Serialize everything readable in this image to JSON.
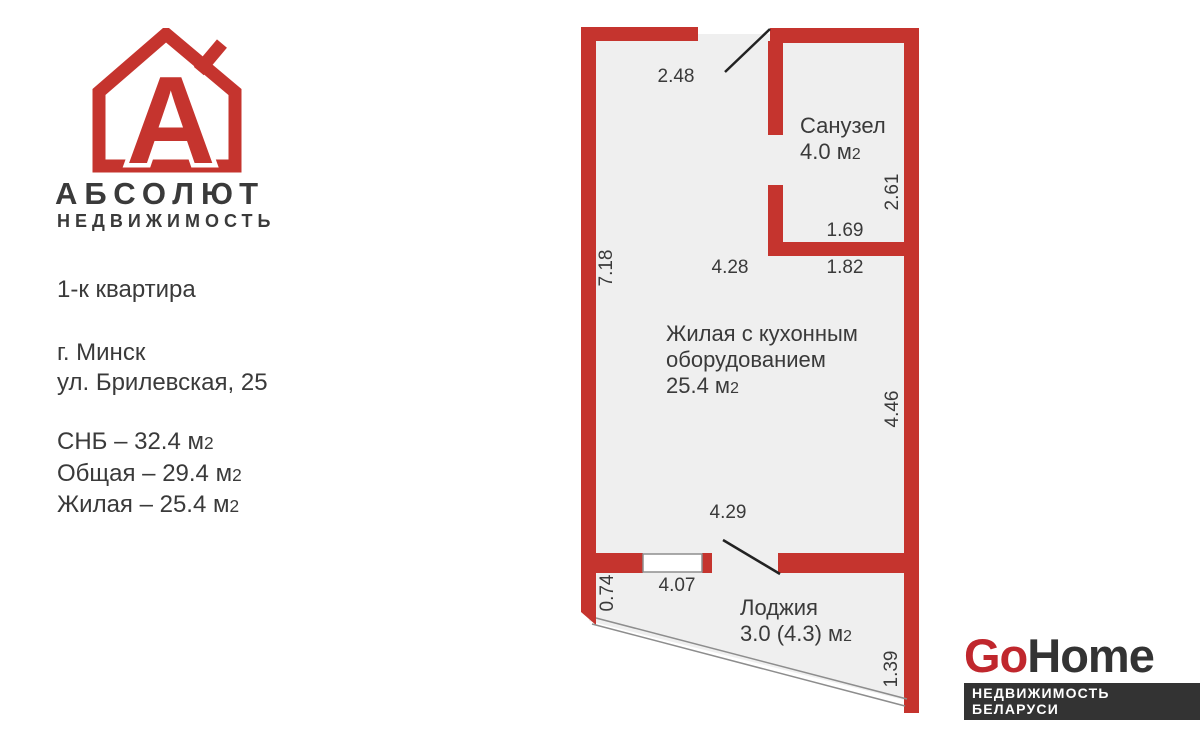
{
  "colors": {
    "wall": "#c5342e",
    "interior": "#efefef",
    "text-dark": "#3a3a3a",
    "door-line": "#222222",
    "thin-line": "#8d8d8d",
    "gohome-red": "#c0272d",
    "gohome-dark": "#333333"
  },
  "brand": {
    "name": "АБСОЛЮТ",
    "subtitle": "НЕДВИЖИМОСТЬ",
    "letter": "A"
  },
  "listing": {
    "type": "1-к квартира",
    "city": "г. Минск",
    "street": "ул. Брилевская, 25",
    "areas": [
      {
        "text": "СНБ – 32.4 м",
        "sup": "2"
      },
      {
        "text": "Общая – 29.4 м",
        "sup": "2"
      },
      {
        "text": "Жилая – 25.4 м",
        "sup": "2"
      }
    ]
  },
  "plan": {
    "rooms": {
      "bathroom": {
        "name": "Санузел",
        "area": "4.0 м",
        "sup": "2"
      },
      "living": {
        "line1": "Жилая с кухонным",
        "line2": "оборудованием",
        "area": "25.4 м",
        "sup": "2"
      },
      "loggia": {
        "name": "Лоджия",
        "area": "3.0 (4.3) м",
        "sup": "2"
      }
    },
    "dims": {
      "entry_width": "2.48",
      "left_height": "7.18",
      "living_top_width": "4.28",
      "bathroom_width": "1.69",
      "bathroom_width_outer": "1.82",
      "bathroom_height": "2.61",
      "living_right_height": "4.46",
      "living_bottom_width": "4.29",
      "loggia_width": "4.07",
      "loggia_left_height": "0.74",
      "loggia_right_height": "1.39"
    }
  },
  "footer": {
    "logo_go": "Go",
    "logo_home": "Home",
    "tagline": "НЕДВИЖИМОСТЬ БЕЛАРУСИ"
  }
}
